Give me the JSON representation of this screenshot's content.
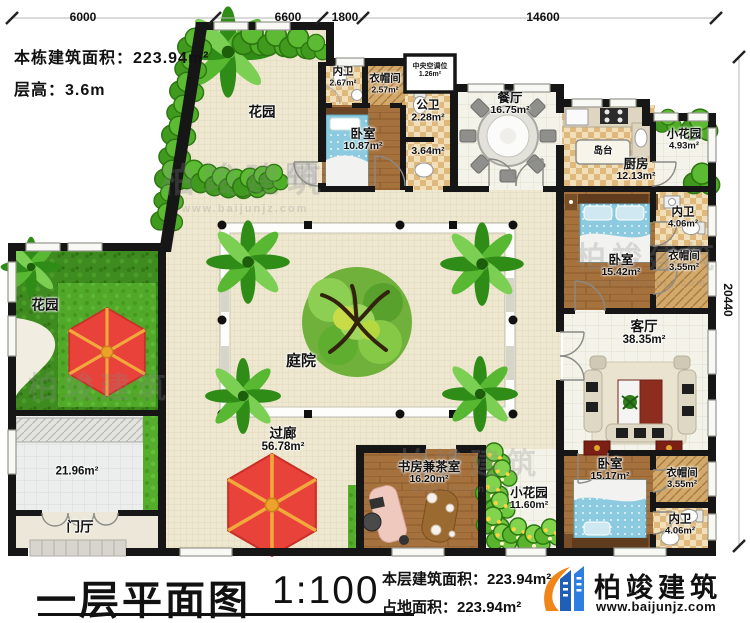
{
  "info": {
    "building_area": "本栋建筑面积：223.94m²",
    "floor_height": "层高：3.6m"
  },
  "dimensions": {
    "top": [
      "6000",
      "6600",
      "1800",
      "14600"
    ],
    "right": "20440"
  },
  "rooms": [
    {
      "name": "花园",
      "area": ""
    },
    {
      "name": "内卫",
      "area": "2.67m²"
    },
    {
      "name": "衣帽间",
      "area": "2.57m²"
    },
    {
      "name": "中央空调位",
      "area": "1.26m²"
    },
    {
      "name": "卧室",
      "area": "10.87m²"
    },
    {
      "name": "公卫",
      "area": "2.28m²"
    },
    {
      "name": "",
      "area": "3.64m²"
    },
    {
      "name": "餐厅",
      "area": "16.75m²"
    },
    {
      "name": "岛台",
      "area": ""
    },
    {
      "name": "厨房",
      "area": "12.13m²"
    },
    {
      "name": "小花园",
      "area": "4.93m²"
    },
    {
      "name": "内卫",
      "area": "4.06m²"
    },
    {
      "name": "卧室",
      "area": "15.42m²"
    },
    {
      "name": "衣帽间",
      "area": "3.55m²"
    },
    {
      "name": "客厅",
      "area": "38.35m²"
    },
    {
      "name": "卧室",
      "area": "15.17m²"
    },
    {
      "name": "衣帽间",
      "area": "3.55m²"
    },
    {
      "name": "内卫",
      "area": "4.06m²"
    },
    {
      "name": "书房兼茶室",
      "area": "16.20m²"
    },
    {
      "name": "小花园",
      "area": "11.60m²"
    },
    {
      "name": "庭院",
      "area": ""
    },
    {
      "name": "过廊",
      "area": "56.78m²"
    },
    {
      "name": "花园",
      "area": ""
    },
    {
      "name": "",
      "area": "21.96m²"
    },
    {
      "name": "门厅",
      "area": ""
    }
  ],
  "title": {
    "text": "一层平面图",
    "scale": "1:100"
  },
  "footer": {
    "floor_area": "本层建筑面积：223.94m²",
    "site_area": "占地面积：223.94m²"
  },
  "brand": {
    "name": "柏竣建筑",
    "url": "www.baijunjz.com"
  },
  "colors": {
    "wall": "#161616",
    "brand_blue": "#1f5fb8",
    "brand_orange": "#f08519",
    "grass": "#3e8c1f",
    "wood_floor": "#a5713c",
    "umbrella_red": "#e8423a",
    "bed_blue": "#8ccbdf"
  }
}
